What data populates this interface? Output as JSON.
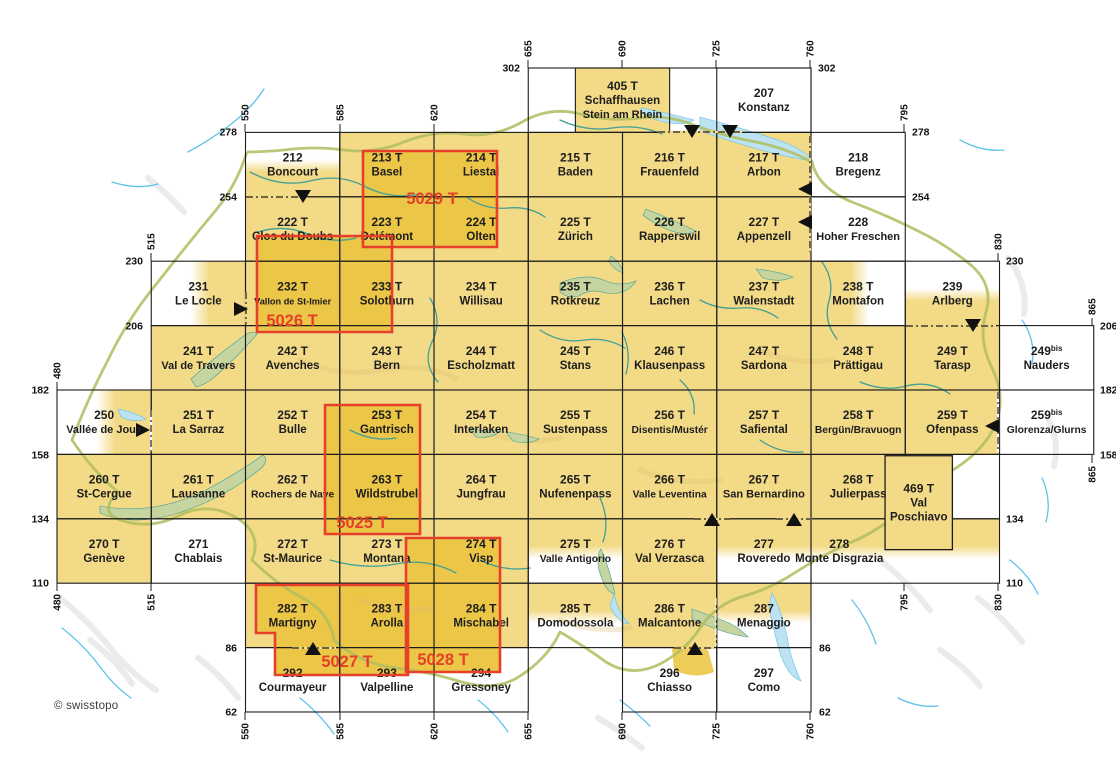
{
  "attribution": "© swisstopo",
  "colors": {
    "sheet_fill": "#F3DA87",
    "sheet_fill_deep": "#ECC647",
    "outside_fill": "#FFFFFF",
    "relief_grey": "#D9DADE",
    "relief_tan": "#DDBE72",
    "lake_green": "#C6D5A0",
    "lake_blue": "#BDE2F2",
    "river_teal": "#3FA096",
    "river_blue": "#5FC3E8",
    "border_olive": "#AFBD5F",
    "grid_line": "#1C1C1C",
    "label_text": "#1D1D1D",
    "composite_red": "#E6402A",
    "tick_text": "#111111"
  },
  "projection": {
    "km_x0": 480,
    "km_y0": 302,
    "px_x0": 57,
    "px_y0": 68,
    "px_per_km_x": 2.6929,
    "px_per_km_y": 2.6833
  },
  "frames": [
    {
      "x": 655,
      "y": 302,
      "w": 105,
      "h": 24
    },
    {
      "x": 795,
      "y": 158,
      "w": 35,
      "h": 24
    }
  ],
  "sheets": [
    {
      "id": "405 T",
      "name": "Schaffhausen\nStein am Rhein",
      "x": 672.5,
      "y": 302,
      "w": 35,
      "h": 24,
      "fill": "ch"
    },
    {
      "id": "207",
      "name": "Konstanz",
      "x": 725,
      "y": 302,
      "w": 35,
      "h": 24,
      "fill": "out"
    },
    {
      "id": "212",
      "name": "Boncourt",
      "x": 550,
      "y": 278,
      "w": 35,
      "h": 24,
      "fill": "yb"
    },
    {
      "id": "213 T",
      "name": "Basel",
      "x": 585,
      "y": 278,
      "w": 35,
      "h": 24,
      "fill": "ch"
    },
    {
      "id": "214 T",
      "name": "Liestal",
      "x": 620,
      "y": 278,
      "w": 35,
      "h": 24,
      "fill": "ch"
    },
    {
      "id": "215 T",
      "name": "Baden",
      "x": 655,
      "y": 278,
      "w": 35,
      "h": 24,
      "fill": "ch"
    },
    {
      "id": "216 T",
      "name": "Frauenfeld",
      "x": 690,
      "y": 278,
      "w": 35,
      "h": 24,
      "fill": "ch"
    },
    {
      "id": "217 T",
      "name": "Arbon",
      "x": 725,
      "y": 278,
      "w": 35,
      "h": 24,
      "fill": "ch"
    },
    {
      "id": "218",
      "name": "Bregenz",
      "x": 760,
      "y": 278,
      "w": 35,
      "h": 24,
      "fill": "out"
    },
    {
      "id": "222 T",
      "name": "Clos du Doubs",
      "x": 550,
      "y": 254,
      "w": 35,
      "h": 24,
      "fill": "ch"
    },
    {
      "id": "223 T",
      "name": "Delémont",
      "x": 585,
      "y": 254,
      "w": 35,
      "h": 24,
      "fill": "ch"
    },
    {
      "id": "224 T",
      "name": "Olten",
      "x": 620,
      "y": 254,
      "w": 35,
      "h": 24,
      "fill": "ch"
    },
    {
      "id": "225 T",
      "name": "Zürich",
      "x": 655,
      "y": 254,
      "w": 35,
      "h": 24,
      "fill": "ch"
    },
    {
      "id": "226 T",
      "name": "Rapperswil",
      "x": 690,
      "y": 254,
      "w": 35,
      "h": 24,
      "fill": "ch"
    },
    {
      "id": "227 T",
      "name": "Appenzell",
      "x": 725,
      "y": 254,
      "w": 35,
      "h": 24,
      "fill": "ch"
    },
    {
      "id": "228",
      "name": "Hoher Freschen",
      "x": 760,
      "y": 254,
      "w": 35,
      "h": 24,
      "fill": "out"
    },
    {
      "id": "231",
      "name": "Le Locle",
      "x": 515,
      "y": 230,
      "w": 35,
      "h": 24,
      "fill": "yr"
    },
    {
      "id": "232 T",
      "name": "Vallon de St-Imier",
      "x": 550,
      "y": 230,
      "w": 35,
      "h": 24,
      "fill": "ch"
    },
    {
      "id": "233 T",
      "name": "Solothurn",
      "x": 585,
      "y": 230,
      "w": 35,
      "h": 24,
      "fill": "ch"
    },
    {
      "id": "234 T",
      "name": "Willisau",
      "x": 620,
      "y": 230,
      "w": 35,
      "h": 24,
      "fill": "ch"
    },
    {
      "id": "235 T",
      "name": "Rotkreuz",
      "x": 655,
      "y": 230,
      "w": 35,
      "h": 24,
      "fill": "ch"
    },
    {
      "id": "236 T",
      "name": "Lachen",
      "x": 690,
      "y": 230,
      "w": 35,
      "h": 24,
      "fill": "ch"
    },
    {
      "id": "237 T",
      "name": "Walenstadt",
      "x": 725,
      "y": 230,
      "w": 35,
      "h": 24,
      "fill": "ch"
    },
    {
      "id": "238 T",
      "name": "Montafon",
      "x": 760,
      "y": 230,
      "w": 35,
      "h": 24,
      "fill": "yl"
    },
    {
      "id": "239",
      "name": "Arlberg",
      "x": 795,
      "y": 230,
      "w": 35,
      "h": 24,
      "fill": "yb"
    },
    {
      "id": "241 T",
      "name": "Val de Travers",
      "x": 515,
      "y": 206,
      "w": 35,
      "h": 24,
      "fill": "ch"
    },
    {
      "id": "242 T",
      "name": "Avenches",
      "x": 550,
      "y": 206,
      "w": 35,
      "h": 24,
      "fill": "ch"
    },
    {
      "id": "243 T",
      "name": "Bern",
      "x": 585,
      "y": 206,
      "w": 35,
      "h": 24,
      "fill": "ch"
    },
    {
      "id": "244 T",
      "name": "Escholzmatt",
      "x": 620,
      "y": 206,
      "w": 35,
      "h": 24,
      "fill": "ch"
    },
    {
      "id": "245 T",
      "name": "Stans",
      "x": 655,
      "y": 206,
      "w": 35,
      "h": 24,
      "fill": "ch"
    },
    {
      "id": "246 T",
      "name": "Klausenpass",
      "x": 690,
      "y": 206,
      "w": 35,
      "h": 24,
      "fill": "ch"
    },
    {
      "id": "247 T",
      "name": "Sardona",
      "x": 725,
      "y": 206,
      "w": 35,
      "h": 24,
      "fill": "ch"
    },
    {
      "id": "248 T",
      "name": "Prättigau",
      "x": 760,
      "y": 206,
      "w": 35,
      "h": 24,
      "fill": "ch"
    },
    {
      "id": "249 T",
      "name": "Tarasp",
      "x": 795,
      "y": 206,
      "w": 35,
      "h": 24,
      "fill": "ch"
    },
    {
      "id": "249",
      "sup": "bis",
      "name": "Nauders",
      "x": 830,
      "y": 206,
      "w": 35,
      "h": 24,
      "fill": "out"
    },
    {
      "id": "250",
      "name": "Vallée de Joux",
      "x": 480,
      "y": 182,
      "w": 35,
      "h": 24,
      "fill": "yr"
    },
    {
      "id": "251 T",
      "name": "La Sarraz",
      "x": 515,
      "y": 182,
      "w": 35,
      "h": 24,
      "fill": "ch"
    },
    {
      "id": "252 T",
      "name": "Bulle",
      "x": 550,
      "y": 182,
      "w": 35,
      "h": 24,
      "fill": "ch"
    },
    {
      "id": "253 T",
      "name": "Gantrisch",
      "x": 585,
      "y": 182,
      "w": 35,
      "h": 24,
      "fill": "ch"
    },
    {
      "id": "254 T",
      "name": "Interlaken",
      "x": 620,
      "y": 182,
      "w": 35,
      "h": 24,
      "fill": "ch"
    },
    {
      "id": "255 T",
      "name": "Sustenpass",
      "x": 655,
      "y": 182,
      "w": 35,
      "h": 24,
      "fill": "ch"
    },
    {
      "id": "256 T",
      "name": "Disentis/Mustér",
      "x": 690,
      "y": 182,
      "w": 35,
      "h": 24,
      "fill": "ch"
    },
    {
      "id": "257 T",
      "name": "Safiental",
      "x": 725,
      "y": 182,
      "w": 35,
      "h": 24,
      "fill": "ch"
    },
    {
      "id": "258 T",
      "name": "Bergün/Bravuogn",
      "x": 760,
      "y": 182,
      "w": 35,
      "h": 24,
      "fill": "ch"
    },
    {
      "id": "259 T",
      "name": "Ofenpass",
      "x": 795,
      "y": 182,
      "w": 35,
      "h": 24,
      "fill": "ch"
    },
    {
      "id": "259",
      "sup": "bis",
      "name": "Glorenza/Glurns",
      "x": 830,
      "y": 182,
      "w": 35,
      "h": 24,
      "fill": "out"
    },
    {
      "id": "260 T",
      "name": "St-Cergue",
      "x": 480,
      "y": 158,
      "w": 35,
      "h": 24,
      "fill": "ch"
    },
    {
      "id": "261 T",
      "name": "Lausanne",
      "x": 515,
      "y": 158,
      "w": 35,
      "h": 24,
      "fill": "ch"
    },
    {
      "id": "262 T",
      "name": "Rochers de Naye",
      "x": 550,
      "y": 158,
      "w": 35,
      "h": 24,
      "fill": "ch"
    },
    {
      "id": "263 T",
      "name": "Wildstrubel",
      "x": 585,
      "y": 158,
      "w": 35,
      "h": 24,
      "fill": "ch"
    },
    {
      "id": "264 T",
      "name": "Jungfrau",
      "x": 620,
      "y": 158,
      "w": 35,
      "h": 24,
      "fill": "ch"
    },
    {
      "id": "265 T",
      "name": "Nufenenpass",
      "x": 655,
      "y": 158,
      "w": 35,
      "h": 24,
      "fill": "ch"
    },
    {
      "id": "266 T",
      "name": "Valle Leventina",
      "x": 690,
      "y": 158,
      "w": 35,
      "h": 24,
      "fill": "ch"
    },
    {
      "id": "267 T",
      "name": "San Bernardino",
      "x": 725,
      "y": 158,
      "w": 35,
      "h": 24,
      "fill": "ch"
    },
    {
      "id": "268 T",
      "name": "Julierpass",
      "x": 760,
      "y": 158,
      "w": 35,
      "h": 24,
      "fill": "ch"
    },
    {
      "id": "270 T",
      "name": "Genève",
      "x": 480,
      "y": 134,
      "w": 35,
      "h": 24,
      "fill": "ch"
    },
    {
      "id": "271",
      "name": "Chablais",
      "x": 515,
      "y": 134,
      "w": 35,
      "h": 24,
      "fill": "out"
    },
    {
      "id": "272 T",
      "name": "St-Maurice",
      "x": 550,
      "y": 134,
      "w": 35,
      "h": 24,
      "fill": "ch"
    },
    {
      "id": "273 T",
      "name": "Montana",
      "x": 585,
      "y": 134,
      "w": 35,
      "h": 24,
      "fill": "ch"
    },
    {
      "id": "274 T",
      "name": "Visp",
      "x": 620,
      "y": 134,
      "w": 35,
      "h": 24,
      "fill": "ch"
    },
    {
      "id": "275 T",
      "name": "Valle Antigorio",
      "x": 655,
      "y": 134,
      "w": 35,
      "h": 24,
      "fill": "yt"
    },
    {
      "id": "276 T",
      "name": "Val Verzasca",
      "x": 690,
      "y": 134,
      "w": 35,
      "h": 24,
      "fill": "ch"
    },
    {
      "id": "277",
      "name": "Roveredo",
      "x": 725,
      "y": 134,
      "w": 35,
      "h": 24,
      "fill": "yt"
    },
    {
      "id": "278",
      "name": "Monte Disgrazia",
      "x": 760,
      "y": 134,
      "w": 70,
      "h": 24,
      "fill": "yt",
      "dx": -66
    },
    {
      "id": "282 T",
      "name": "Martigny",
      "x": 550,
      "y": 110,
      "w": 35,
      "h": 24,
      "fill": "ch"
    },
    {
      "id": "283 T",
      "name": "Arolla",
      "x": 585,
      "y": 110,
      "w": 35,
      "h": 24,
      "fill": "ch"
    },
    {
      "id": "284 T",
      "name": "Mischabel",
      "x": 620,
      "y": 110,
      "w": 35,
      "h": 24,
      "fill": "ch"
    },
    {
      "id": "285 T",
      "name": "Domodossola",
      "x": 655,
      "y": 110,
      "w": 35,
      "h": 24,
      "fill": "yt"
    },
    {
      "id": "286 T",
      "name": "Malcantone",
      "x": 690,
      "y": 110,
      "w": 35,
      "h": 24,
      "fill": "ch"
    },
    {
      "id": "287",
      "name": "Menaggio",
      "x": 725,
      "y": 110,
      "w": 35,
      "h": 24,
      "fill": "yt"
    },
    {
      "id": "292",
      "name": "Courmayeur",
      "x": 550,
      "y": 86,
      "w": 35,
      "h": 24,
      "fill": "out"
    },
    {
      "id": "293",
      "name": "Valpelline",
      "x": 585,
      "y": 86,
      "w": 35,
      "h": 24,
      "fill": "out"
    },
    {
      "id": "294",
      "name": "Gressoney",
      "x": 620,
      "y": 86,
      "w": 35,
      "h": 24,
      "fill": "out"
    },
    {
      "id": "296",
      "name": "Chiasso",
      "x": 690,
      "y": 86,
      "w": 35,
      "h": 24,
      "fill": "out"
    },
    {
      "id": "297",
      "name": "Como",
      "x": 725,
      "y": 86,
      "w": 35,
      "h": 24,
      "fill": "out"
    },
    {
      "id": "469 T",
      "name": "Val\nPoschiavo",
      "x": 787.5,
      "y": 157.5,
      "w": 25,
      "h": 35,
      "fill": "ch",
      "box": true
    }
  ],
  "composites": [
    {
      "label": "5029 T",
      "points": [
        [
          363,
          151
        ],
        [
          497,
          151
        ],
        [
          497,
          247
        ],
        [
          363,
          247
        ]
      ],
      "label_pos": [
        432,
        204
      ]
    },
    {
      "label": "5026 T",
      "points": [
        [
          257,
          236
        ],
        [
          392,
          236
        ],
        [
          392,
          332
        ],
        [
          257,
          332
        ]
      ],
      "label_pos": [
        292,
        326
      ]
    },
    {
      "label": "5025 T",
      "points": [
        [
          325,
          405
        ],
        [
          420,
          405
        ],
        [
          420,
          534
        ],
        [
          325,
          534
        ]
      ],
      "label_pos": [
        362,
        528
      ]
    },
    {
      "label": "5027 T",
      "points": [
        [
          256,
          585
        ],
        [
          408,
          585
        ],
        [
          408,
          675
        ],
        [
          275,
          675
        ],
        [
          275,
          633
        ],
        [
          256,
          633
        ]
      ],
      "label_pos": [
        347,
        667
      ]
    },
    {
      "label": "5028 T",
      "points": [
        [
          406,
          538
        ],
        [
          500,
          538
        ],
        [
          500,
          672
        ],
        [
          406,
          672
        ]
      ],
      "label_pos": [
        443,
        665
      ]
    }
  ],
  "ticks": [
    {
      "v": "480",
      "x": 57,
      "end": 390,
      "dir": "up"
    },
    {
      "v": "515",
      "x": 151,
      "end": 261,
      "dir": "up"
    },
    {
      "v": "550",
      "x": 245,
      "end": 132,
      "dir": "up"
    },
    {
      "v": "585",
      "x": 340,
      "end": 132,
      "dir": "up"
    },
    {
      "v": "620",
      "x": 434,
      "end": 132,
      "dir": "up"
    },
    {
      "v": "655",
      "x": 528,
      "end": 68,
      "dir": "up"
    },
    {
      "v": "690",
      "x": 622,
      "end": 68,
      "dir": "up"
    },
    {
      "v": "725",
      "x": 716,
      "end": 68,
      "dir": "up"
    },
    {
      "v": "760",
      "x": 810,
      "end": 68,
      "dir": "up"
    },
    {
      "v": "795",
      "x": 904,
      "end": 132,
      "dir": "up"
    },
    {
      "v": "830",
      "x": 998,
      "end": 261,
      "dir": "up"
    },
    {
      "v": "865",
      "x": 1092,
      "end": 326,
      "dir": "up"
    },
    {
      "v": "480",
      "x": 57,
      "end": 583,
      "dir": "down"
    },
    {
      "v": "515",
      "x": 151,
      "end": 583,
      "dir": "down"
    },
    {
      "v": "550",
      "x": 245,
      "end": 712,
      "dir": "down"
    },
    {
      "v": "585",
      "x": 340,
      "end": 712,
      "dir": "down"
    },
    {
      "v": "620",
      "x": 434,
      "end": 712,
      "dir": "down"
    },
    {
      "v": "655",
      "x": 528,
      "end": 712,
      "dir": "down"
    },
    {
      "v": "690",
      "x": 622,
      "end": 712,
      "dir": "down"
    },
    {
      "v": "725",
      "x": 716,
      "end": 712,
      "dir": "down"
    },
    {
      "v": "760",
      "x": 810,
      "end": 712,
      "dir": "down"
    },
    {
      "v": "795",
      "x": 904,
      "end": 583,
      "dir": "down"
    },
    {
      "v": "830",
      "x": 998,
      "end": 583,
      "dir": "down"
    },
    {
      "v": "865",
      "x": 1092,
      "end": 455,
      "dir": "down"
    }
  ],
  "row_labels": [
    {
      "v": "302",
      "x": 520,
      "y": 68,
      "side": "left"
    },
    {
      "v": "302",
      "x": 818,
      "y": 68,
      "side": "right"
    },
    {
      "v": "278",
      "x": 237,
      "y": 132,
      "side": "left"
    },
    {
      "v": "278",
      "x": 912,
      "y": 132,
      "side": "right"
    },
    {
      "v": "254",
      "x": 237,
      "y": 197,
      "side": "left"
    },
    {
      "v": "254",
      "x": 912,
      "y": 197,
      "side": "right"
    },
    {
      "v": "230",
      "x": 143,
      "y": 261,
      "side": "left"
    },
    {
      "v": "230",
      "x": 1006,
      "y": 261,
      "side": "right"
    },
    {
      "v": "206",
      "x": 143,
      "y": 326,
      "side": "left"
    },
    {
      "v": "206",
      "x": 1100,
      "y": 326,
      "side": "right"
    },
    {
      "v": "182",
      "x": 49,
      "y": 390,
      "side": "left"
    },
    {
      "v": "182",
      "x": 1100,
      "y": 390,
      "side": "right"
    },
    {
      "v": "158",
      "x": 49,
      "y": 455,
      "side": "left"
    },
    {
      "v": "158",
      "x": 1100,
      "y": 455,
      "side": "right"
    },
    {
      "v": "134",
      "x": 49,
      "y": 519,
      "side": "left"
    },
    {
      "v": "134",
      "x": 1006,
      "y": 519,
      "side": "right"
    },
    {
      "v": "110",
      "x": 49,
      "y": 583,
      "side": "left"
    },
    {
      "v": "110",
      "x": 1006,
      "y": 583,
      "side": "right"
    },
    {
      "v": "86",
      "x": 237,
      "y": 648,
      "side": "left"
    },
    {
      "v": "86",
      "x": 819,
      "y": 648,
      "side": "right"
    },
    {
      "v": "62",
      "x": 237,
      "y": 712,
      "side": "left"
    },
    {
      "v": "62",
      "x": 819,
      "y": 712,
      "side": "right"
    }
  ],
  "markers": [
    {
      "dir": "down",
      "x": 303,
      "y": 197
    },
    {
      "dir": "down",
      "x": 692,
      "y": 132
    },
    {
      "dir": "down",
      "x": 730,
      "y": 132
    },
    {
      "dir": "down",
      "x": 973,
      "y": 326
    },
    {
      "dir": "up",
      "x": 712,
      "y": 519
    },
    {
      "dir": "up",
      "x": 794,
      "y": 519
    },
    {
      "dir": "up",
      "x": 313,
      "y": 648
    },
    {
      "dir": "up",
      "x": 695,
      "y": 648
    },
    {
      "dir": "right",
      "x": 240,
      "y": 309
    },
    {
      "dir": "right",
      "x": 142,
      "y": 430
    },
    {
      "dir": "left",
      "x": 806,
      "y": 189
    },
    {
      "dir": "left",
      "x": 806,
      "y": 222
    },
    {
      "dir": "left",
      "x": 993,
      "y": 426
    }
  ],
  "dashes": [
    {
      "x1": 658,
      "y1": 132,
      "x2": 742,
      "y2": 132
    },
    {
      "x1": 246,
      "y1": 197,
      "x2": 300,
      "y2": 197
    },
    {
      "x1": 810,
      "y1": 136,
      "x2": 810,
      "y2": 252
    },
    {
      "x1": 906,
      "y1": 326,
      "x2": 996,
      "y2": 326
    },
    {
      "x1": 998,
      "y1": 392,
      "x2": 998,
      "y2": 452,
      "bg": "#FFFFFF"
    },
    {
      "x1": 694,
      "y1": 519,
      "x2": 730,
      "y2": 519
    },
    {
      "x1": 776,
      "y1": 519,
      "x2": 812,
      "y2": 519
    },
    {
      "x1": 292,
      "y1": 648,
      "x2": 336,
      "y2": 648
    },
    {
      "x1": 674,
      "y1": 648,
      "x2": 714,
      "y2": 648
    },
    {
      "x1": 151,
      "y1": 410,
      "x2": 151,
      "y2": 452,
      "bg": "#FFFFFF"
    },
    {
      "x1": 246,
      "y1": 292,
      "x2": 246,
      "y2": 324
    },
    {
      "x1": 716,
      "y1": 598,
      "x2": 716,
      "y2": 646,
      "white": true
    }
  ]
}
